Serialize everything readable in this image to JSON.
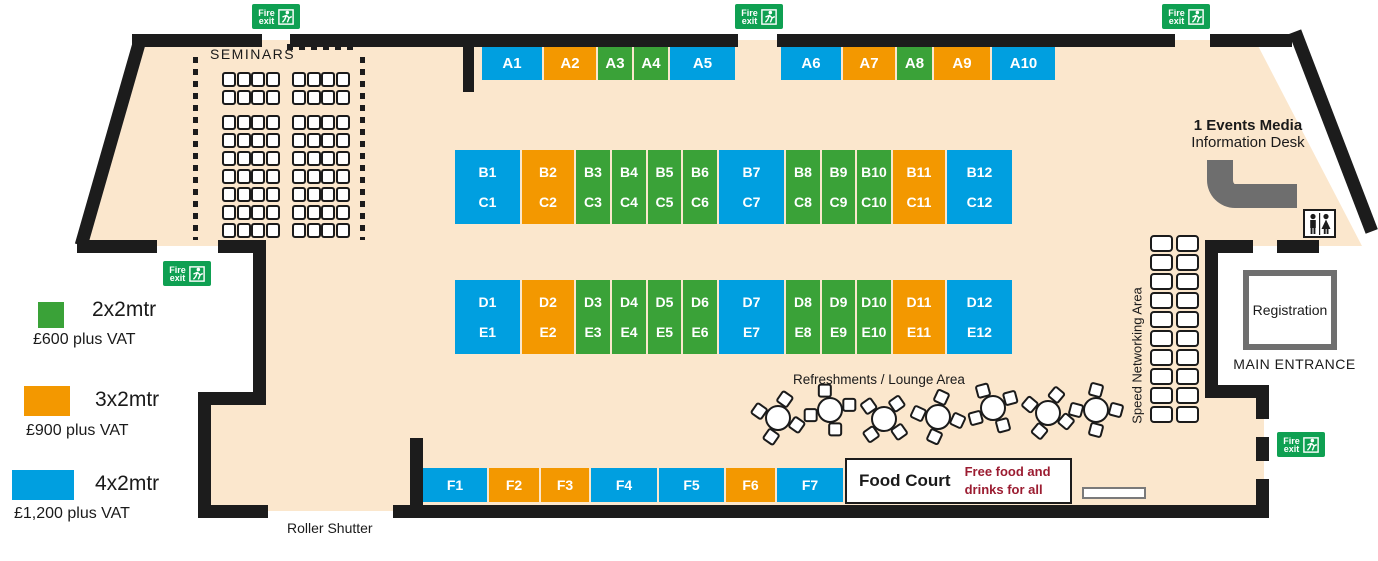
{
  "colors": {
    "floor": "#FBE7CD",
    "wall": "#1C1C1C",
    "green": "#3AA238",
    "orange": "#F39800",
    "blue": "#009FE0",
    "fire_green": "#0FA052",
    "maroon": "#9B1C31",
    "desk_gray": "#6E6E6E"
  },
  "legend": {
    "items": [
      {
        "label": "2x2mtr",
        "price": "£600 plus VAT",
        "size": "2x2"
      },
      {
        "label": "3x2mtr",
        "price": "£900 plus VAT",
        "size": "3x2"
      },
      {
        "label": "4x2mtr",
        "price": "£1,200 plus VAT",
        "size": "4x2"
      }
    ]
  },
  "areas": {
    "seminars": "SEMINARS",
    "speed_networking": "Speed Networking Area",
    "refreshments": "Refreshments / Lounge Area",
    "roller_shutter": "Roller Shutter",
    "registration": "Registration",
    "main_entrance": "MAIN ENTRANCE",
    "info_desk_line1": "1 Events Media",
    "info_desk_line2": "Information Desk"
  },
  "food_court": {
    "title": "Food Court",
    "note_line1": "Free food and",
    "note_line2": "drinks for all"
  },
  "fire_exit": {
    "line1": "Fire",
    "line2": "exit",
    "positions": [
      {
        "x": 252,
        "y": 4
      },
      {
        "x": 735,
        "y": 4
      },
      {
        "x": 1162,
        "y": 4
      },
      {
        "x": 163,
        "y": 261
      },
      {
        "x": 1277,
        "y": 432
      }
    ]
  },
  "stand_rows": [
    {
      "name": "A",
      "y": 47,
      "h": 33,
      "label_size": 15,
      "stands": [
        {
          "labels": [
            "A1"
          ],
          "x": 482,
          "w": 60,
          "size": "4x2"
        },
        {
          "labels": [
            "A2"
          ],
          "x": 544,
          "w": 52,
          "size": "3x2"
        },
        {
          "labels": [
            "A3"
          ],
          "x": 598,
          "w": 34,
          "size": "2x2"
        },
        {
          "labels": [
            "A4"
          ],
          "x": 634,
          "w": 34,
          "size": "2x2"
        },
        {
          "labels": [
            "A5"
          ],
          "x": 670,
          "w": 65,
          "size": "4x2"
        },
        {
          "labels": [
            "A6"
          ],
          "x": 781,
          "w": 60,
          "size": "4x2"
        },
        {
          "labels": [
            "A7"
          ],
          "x": 843,
          "w": 52,
          "size": "3x2"
        },
        {
          "labels": [
            "A8"
          ],
          "x": 897,
          "w": 35,
          "size": "2x2"
        },
        {
          "labels": [
            "A9"
          ],
          "x": 934,
          "w": 56,
          "size": "3x2"
        },
        {
          "labels": [
            "A10"
          ],
          "x": 992,
          "w": 63,
          "size": "4x2"
        }
      ]
    },
    {
      "name": "BC",
      "y": 150,
      "h": 74,
      "label_size": 14,
      "stands": [
        {
          "labels": [
            "B1",
            "C1"
          ],
          "x": 455,
          "w": 65,
          "size": "4x2"
        },
        {
          "labels": [
            "B2",
            "C2"
          ],
          "x": 522,
          "w": 52,
          "size": "3x2"
        },
        {
          "labels": [
            "B3",
            "C3"
          ],
          "x": 576,
          "w": 34,
          "size": "2x2"
        },
        {
          "labels": [
            "B4",
            "C4"
          ],
          "x": 612,
          "w": 34,
          "size": "2x2"
        },
        {
          "labels": [
            "B5",
            "C5"
          ],
          "x": 648,
          "w": 33,
          "size": "2x2"
        },
        {
          "labels": [
            "B6",
            "C6"
          ],
          "x": 683,
          "w": 34,
          "size": "2x2"
        },
        {
          "labels": [
            "B7",
            "C7"
          ],
          "x": 719,
          "w": 65,
          "size": "4x2"
        },
        {
          "labels": [
            "B8",
            "C8"
          ],
          "x": 786,
          "w": 34,
          "size": "2x2"
        },
        {
          "labels": [
            "B9",
            "C9"
          ],
          "x": 822,
          "w": 33,
          "size": "2x2"
        },
        {
          "labels": [
            "B10",
            "C10"
          ],
          "x": 857,
          "w": 34,
          "size": "2x2"
        },
        {
          "labels": [
            "B11",
            "C11"
          ],
          "x": 893,
          "w": 52,
          "size": "3x2"
        },
        {
          "labels": [
            "B12",
            "C12"
          ],
          "x": 947,
          "w": 65,
          "size": "4x2"
        }
      ]
    },
    {
      "name": "DE",
      "y": 280,
      "h": 74,
      "label_size": 14,
      "stands": [
        {
          "labels": [
            "D1",
            "E1"
          ],
          "x": 455,
          "w": 65,
          "size": "4x2"
        },
        {
          "labels": [
            "D2",
            "E2"
          ],
          "x": 522,
          "w": 52,
          "size": "3x2"
        },
        {
          "labels": [
            "D3",
            "E3"
          ],
          "x": 576,
          "w": 34,
          "size": "2x2"
        },
        {
          "labels": [
            "D4",
            "E4"
          ],
          "x": 612,
          "w": 34,
          "size": "2x2"
        },
        {
          "labels": [
            "D5",
            "E5"
          ],
          "x": 648,
          "w": 33,
          "size": "2x2"
        },
        {
          "labels": [
            "D6",
            "E6"
          ],
          "x": 683,
          "w": 34,
          "size": "2x2"
        },
        {
          "labels": [
            "D7",
            "E7"
          ],
          "x": 719,
          "w": 65,
          "size": "4x2"
        },
        {
          "labels": [
            "D8",
            "E8"
          ],
          "x": 786,
          "w": 34,
          "size": "2x2"
        },
        {
          "labels": [
            "D9",
            "E9"
          ],
          "x": 822,
          "w": 33,
          "size": "2x2"
        },
        {
          "labels": [
            "D10",
            "E10"
          ],
          "x": 857,
          "w": 34,
          "size": "2x2"
        },
        {
          "labels": [
            "D11",
            "E11"
          ],
          "x": 893,
          "w": 52,
          "size": "3x2"
        },
        {
          "labels": [
            "D12",
            "E12"
          ],
          "x": 947,
          "w": 65,
          "size": "4x2"
        }
      ]
    },
    {
      "name": "F",
      "y": 468,
      "h": 34,
      "label_size": 14,
      "stands": [
        {
          "labels": [
            "F1"
          ],
          "x": 423,
          "w": 64,
          "size": "4x2"
        },
        {
          "labels": [
            "F2"
          ],
          "x": 489,
          "w": 50,
          "size": "3x2"
        },
        {
          "labels": [
            "F3"
          ],
          "x": 541,
          "w": 48,
          "size": "3x2"
        },
        {
          "labels": [
            "F4"
          ],
          "x": 591,
          "w": 66,
          "size": "4x2"
        },
        {
          "labels": [
            "F5"
          ],
          "x": 659,
          "w": 65,
          "size": "4x2"
        },
        {
          "labels": [
            "F6"
          ],
          "x": 726,
          "w": 49,
          "size": "3x2"
        },
        {
          "labels": [
            "F7"
          ],
          "x": 777,
          "w": 66,
          "size": "4x2"
        }
      ]
    }
  ],
  "seminar_seating": {
    "blocks": 2,
    "rows": 9,
    "chairs_per_row": 4
  },
  "networking_seating": {
    "cols": 2,
    "rows": 10
  },
  "lounge_tables": [
    {
      "x": 778,
      "y": 418,
      "r": 20
    },
    {
      "x": 830,
      "y": 410,
      "r": -15
    },
    {
      "x": 884,
      "y": 419,
      "r": 40
    },
    {
      "x": 938,
      "y": 417,
      "r": 10
    },
    {
      "x": 993,
      "y": 408,
      "r": -30
    },
    {
      "x": 1048,
      "y": 413,
      "r": 25
    },
    {
      "x": 1096,
      "y": 410,
      "r": 0
    }
  ]
}
